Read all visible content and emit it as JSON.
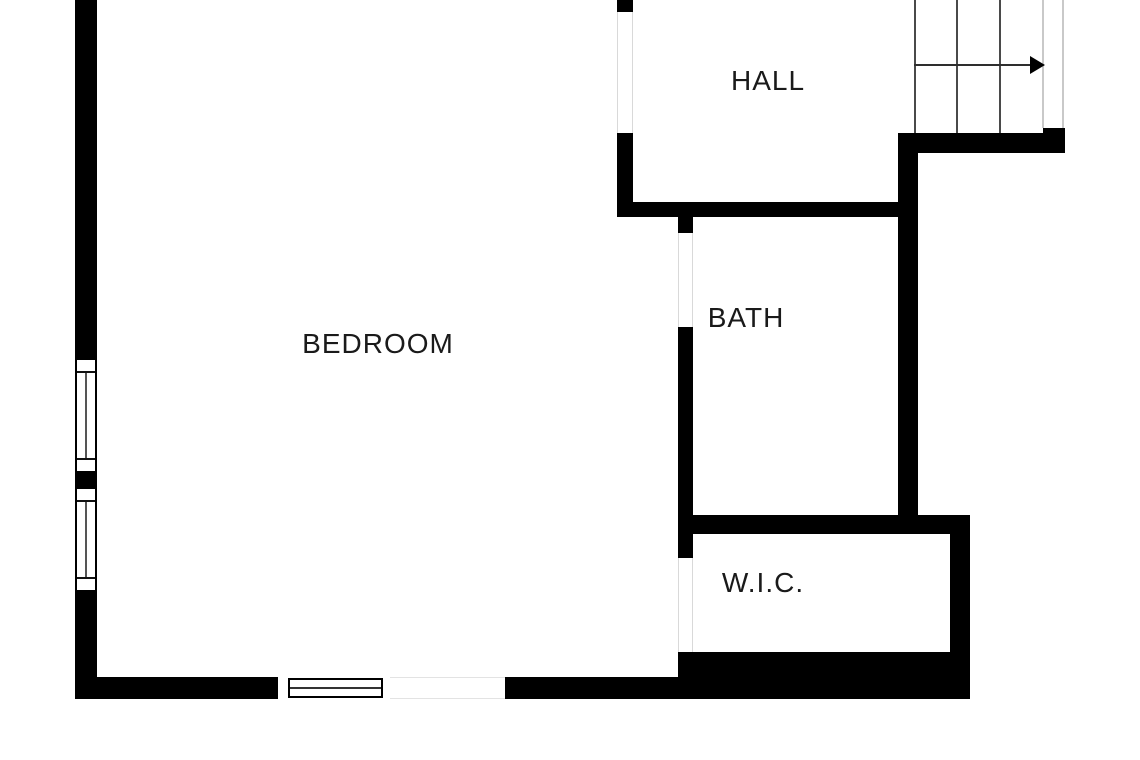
{
  "plan": {
    "type": "floor-plan",
    "rooms": [
      {
        "id": "bedroom",
        "label": "BEDROOM"
      },
      {
        "id": "hall",
        "label": "HALL"
      },
      {
        "id": "bath",
        "label": "BATH"
      },
      {
        "id": "wic",
        "label": "W.I.C."
      }
    ],
    "stairs": {
      "tread_lines": 3,
      "arrow_direction": "right"
    },
    "windows": {
      "left_wall_count": 2,
      "bottom_wall_count": 1
    },
    "colors": {
      "wall": "#000000",
      "background": "#ffffff",
      "label_text": "#1a1a1a",
      "stair_tread_line": "#4a4a4a",
      "stair_side_line": "#c9c9c9",
      "window_mullion": "#555555"
    }
  }
}
